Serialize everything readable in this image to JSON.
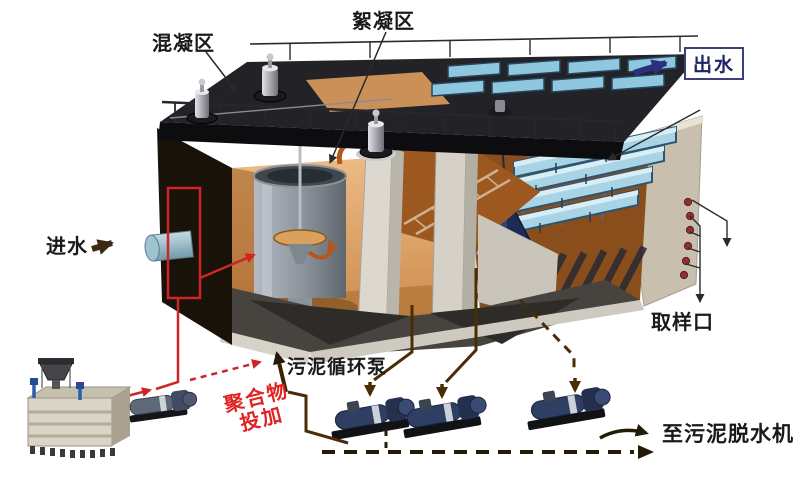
{
  "diagram": {
    "labels": {
      "coagulation_zone": "混凝区",
      "flocculation_zone": "絮凝区",
      "effluent": "出水",
      "influent": "进水",
      "sludge_circulation_pump": "污泥循环泵",
      "sampling_port": "取样口",
      "polymer_dosing_line1": "聚合物",
      "polymer_dosing_line2": "投加",
      "to_sludge_dewatering": "至污泥脱水机"
    },
    "icons": {
      "effluent-arrow-icon": "→",
      "influent-arrow-icon": "→",
      "sampling-down-arrow-icon": "↓",
      "sludge-circulation-up-arrow-icon": "↑",
      "dewatering-arrow-icon": "→",
      "circulation-curl-arrow-icon": "↻"
    },
    "colors": {
      "background": "#ffffff",
      "deck": "#232327",
      "tank_wall": "#c9bfae",
      "interior_orange": "#e2a96b",
      "water_brown": "#9c581e",
      "trough_blue": "#a8d4e6",
      "trough_frame": "#2e5570",
      "cone_navy": "#1d2b55",
      "hopper_dark": "#47443f",
      "pump_body": "#2e3f63",
      "polymer_line_red": "#cc2427",
      "polymer_text_red": "#e02222",
      "sludge_line_brown": "#4a2d07",
      "effluent_arrow": "#2b2f7e",
      "influent_arrow": "#3d2a12",
      "label_text": "#1a1a1a"
    }
  }
}
